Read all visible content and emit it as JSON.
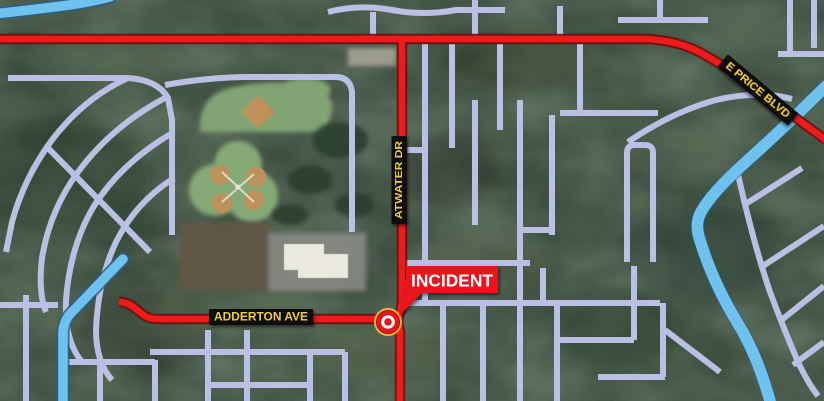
{
  "map": {
    "road_labels": [
      {
        "id": "e-price-blvd",
        "text": "E PRICE BLVD"
      },
      {
        "id": "atwater-dr",
        "text": "ATWATER DR"
      },
      {
        "id": "adderton-ave",
        "text": "ADDERTON AVE"
      }
    ],
    "incident_label": "INCIDENT",
    "colors": {
      "highlight_road": "#ee1b1b",
      "street": "#b9c0e4",
      "water": "#6fc2ee",
      "road_label_bg": "#0a0a0a",
      "road_label_text": "#f0cd3f",
      "incident_bg": "#e8141c",
      "incident_text": "#ffffff",
      "marker_ring": "#ffffff",
      "marker_halo": "#eeb33f"
    }
  }
}
